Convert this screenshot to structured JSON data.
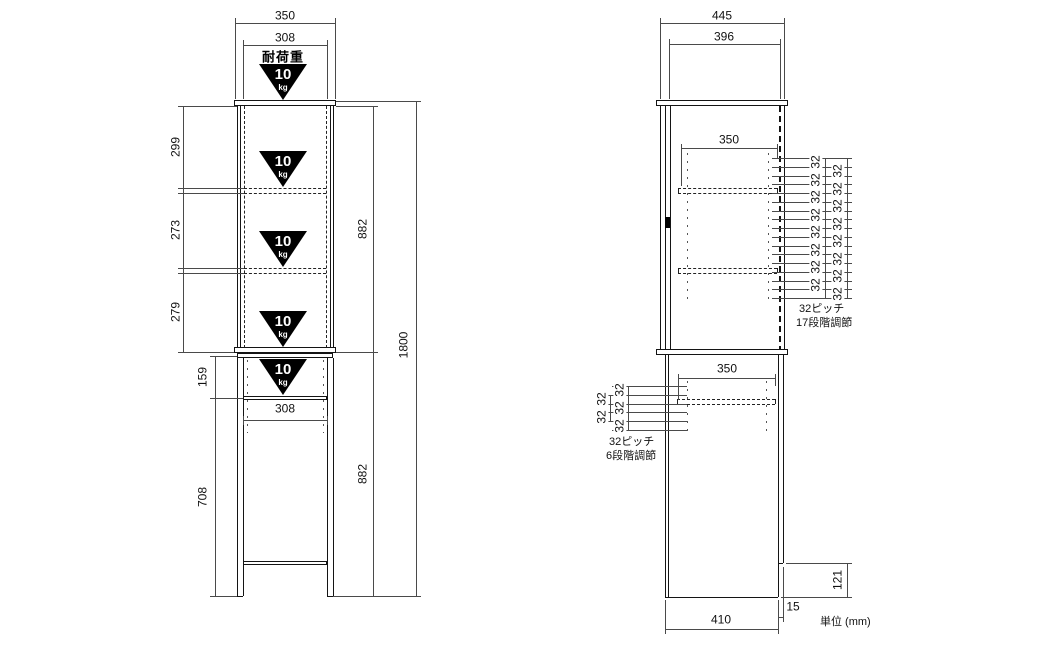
{
  "front_view": {
    "load": {
      "label": "耐荷重",
      "value": "10",
      "unit": "kg"
    },
    "dims": {
      "width_overall": "350",
      "width_interior": "308",
      "section_top": "299",
      "section_middle": "273",
      "section_bottom": "279",
      "upper_height": "882",
      "lower_height": "882",
      "total_height": "1800",
      "open_shelf_height": "159",
      "leg_height": "708",
      "lower_shelf_width": "308"
    }
  },
  "side_view": {
    "dims": {
      "depth_overall": "445",
      "depth_interior": "396",
      "upper_shelf_depth": "350",
      "lower_shelf_depth": "350",
      "base_notch_height": "121",
      "back_panel_inset": "15",
      "base_depth": "410"
    },
    "pitch_top": {
      "gap_label": "32",
      "holes": 17,
      "note1": "32ピッチ",
      "note2": "17段階調節"
    },
    "pitch_bottom": {
      "gap_label": "32",
      "holes": 6,
      "note1": "32ピッチ",
      "note2": "6段階調節"
    }
  },
  "units_note": "単位 (mm)",
  "colors": {
    "line": "#141414",
    "dim_line": "#4a4a4a",
    "badge": "#000000",
    "background": "#ffffff"
  }
}
